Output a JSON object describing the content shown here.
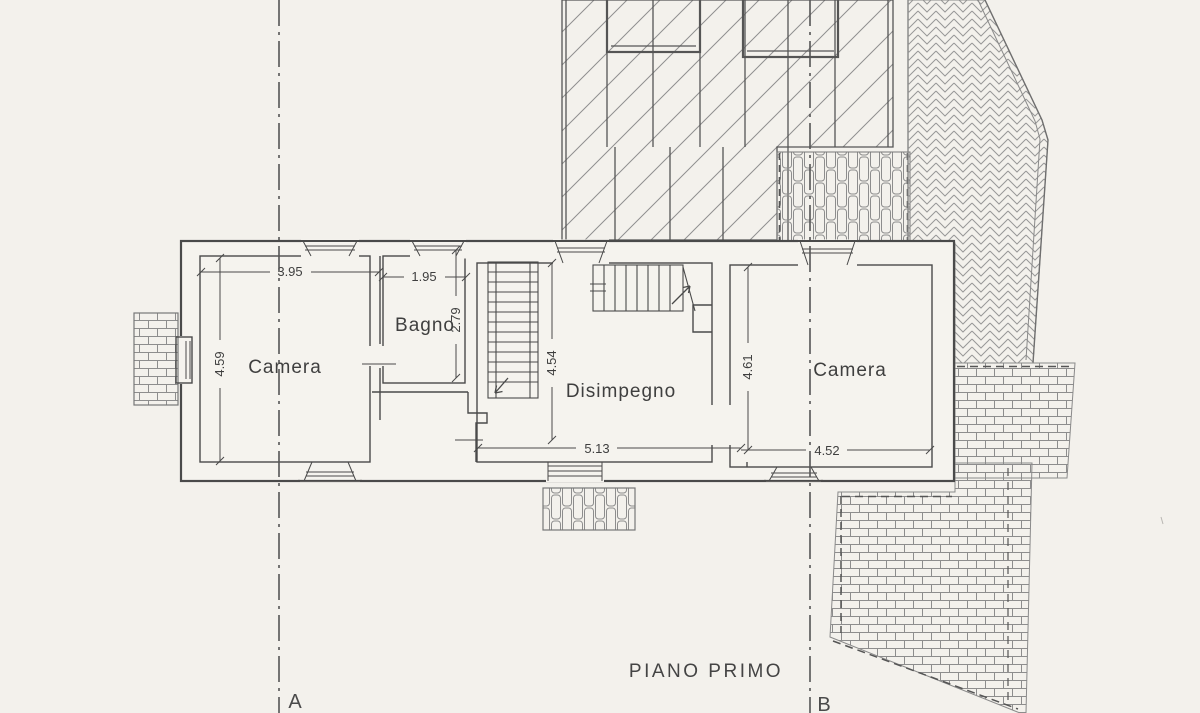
{
  "document": {
    "title": "PIANO PRIMO"
  },
  "plan": {
    "rooms": [
      {
        "name": "Camera"
      },
      {
        "name": "Bagno"
      },
      {
        "name": "Disimpegno"
      },
      {
        "name": "Camera"
      }
    ],
    "dimensions": {
      "camera_left_width": "3.95",
      "camera_left_depth": "4.59",
      "bagno_width": "1.95",
      "bagno_depth": "2.79",
      "stair_hall_depth": "4.54",
      "disimpegno_width": "5.13",
      "camera_right_depth": "4.61",
      "camera_right_width": "4.52"
    },
    "section_markers": {
      "a": "A",
      "b": "B"
    }
  },
  "colors": {
    "paper": "#f3f1ec",
    "ink": "#4a4a4a",
    "ink_light": "#8d8d8d"
  }
}
